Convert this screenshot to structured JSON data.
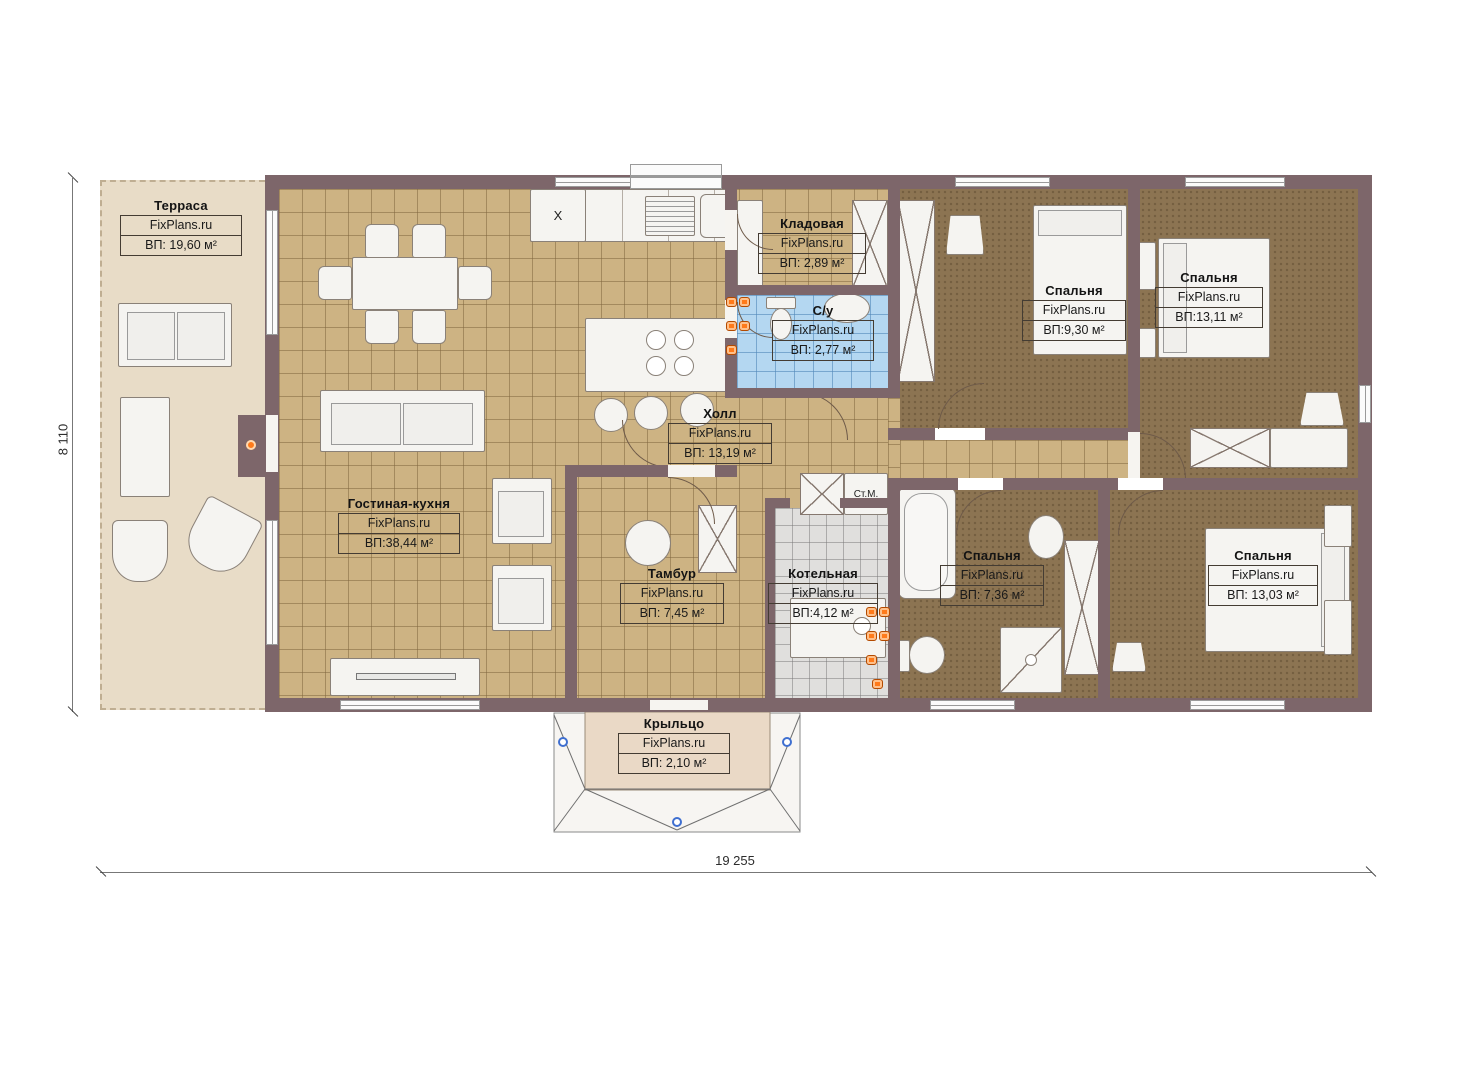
{
  "watermark": "FixPlans.ru",
  "rooms": [
    {
      "id": "terrace",
      "name": "Терраса",
      "area": "ВП: 19,60 м²"
    },
    {
      "id": "living-kitchen",
      "name": "Гостиная-кухня",
      "area": "ВП:38,44 м²"
    },
    {
      "id": "storage",
      "name": "Кладовая",
      "area": "ВП: 2,89 м²"
    },
    {
      "id": "bathroom",
      "name": "С/у",
      "area": "ВП: 2,77 м²"
    },
    {
      "id": "hall",
      "name": "Холл",
      "area": "ВП: 13,19 м²"
    },
    {
      "id": "bedroom-1",
      "name": "Спальня",
      "area": "ВП:9,30 м²"
    },
    {
      "id": "bedroom-2",
      "name": "Спальня",
      "area": "ВП:13,11 м²"
    },
    {
      "id": "vestibule",
      "name": "Тамбур",
      "area": "ВП: 7,45 м²"
    },
    {
      "id": "boiler-room",
      "name": "Котельная",
      "area": "ВП:4,12 м²"
    },
    {
      "id": "bedroom-3",
      "name": "Спальня",
      "area": "ВП: 7,36 м²"
    },
    {
      "id": "bedroom-4",
      "name": "Спальня",
      "area": "ВП: 13,03 м²"
    },
    {
      "id": "porch",
      "name": "Крыльцо",
      "area": "ВП: 2,10 м²"
    }
  ],
  "annotations": {
    "washing_machine": "Ст.М.",
    "fridge_symbol": "X"
  },
  "dimensions": {
    "overall_width": "19 255",
    "overall_height": "8 110"
  },
  "colors": {
    "wall": "#7d666a",
    "tile_floor": "#cdb383",
    "bedroom_floor": "#8c7452",
    "terrace_floor": "#e8dcc7",
    "bath_tile": "#b4d7f1",
    "boiler_tile": "#e0dfdd",
    "radiator": "#ff7a1a",
    "handle": "#3f6fd0"
  }
}
